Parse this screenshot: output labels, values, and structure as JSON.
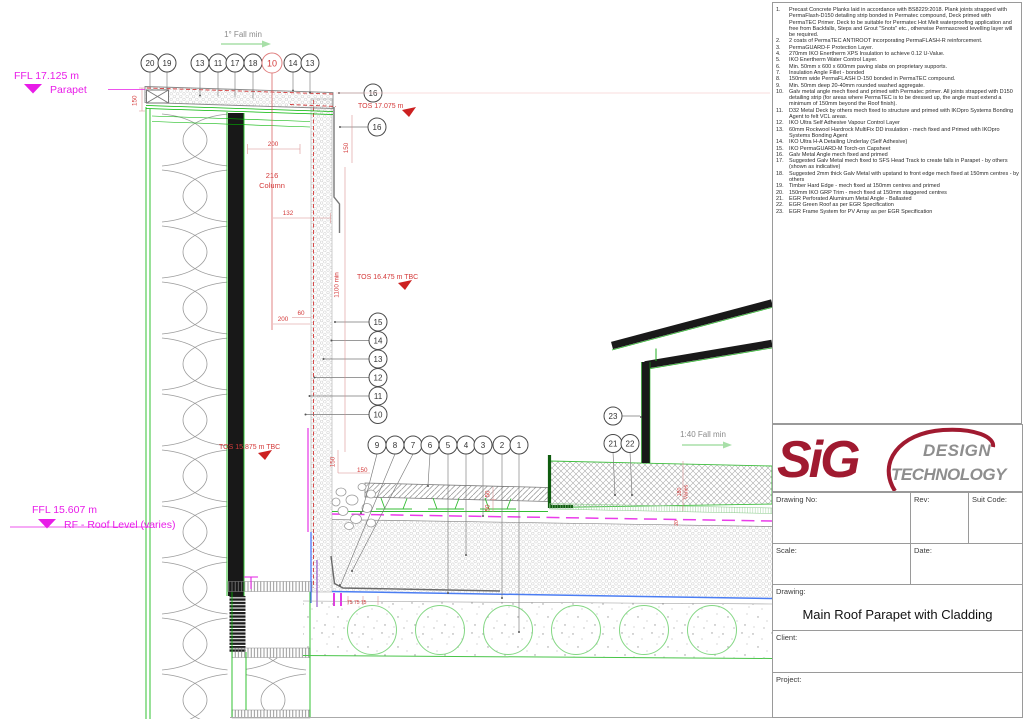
{
  "notes": {
    "items": [
      {
        "n": "1.",
        "t": "Precast Concrete Planks laid in accordance with BS8229:2018.  Plank joints strapped with PermaFlash-D150 detailing strip bonded in Permatec compound, Deck primed with PermaTEC Primer.  Deck to be suitable for Permatec Hot Melt waterproofing application and free from Backfalls, Steps and Grout \"Snots\" etc., otherwise Permascreed levelling layer will be required."
      },
      {
        "n": "2.",
        "t": "2 coats of PermaTEC ANTIROOT incorporating PermaFLASH-R reinforcement."
      },
      {
        "n": "3.",
        "t": "PermaGUARD-F Protection Layer."
      },
      {
        "n": "4.",
        "t": "270mm IKO Enertherm XPS Insulation to achieve 0.12 U-Value."
      },
      {
        "n": "5.",
        "t": "IKO Enertherm Water Control Layer."
      },
      {
        "n": "6.",
        "t": "Min. 50mm x 600 x 600mm paving slabs on proprietary supports."
      },
      {
        "n": "7.",
        "t": "Insulation Angle Fillet - bonded"
      },
      {
        "n": "8.",
        "t": "150mm wide PermaFLASH D-150 bonded in PermaTEC compound."
      },
      {
        "n": "9.",
        "t": "Min. 50mm deep 20-40mm rounded washed aggregate."
      },
      {
        "n": "10.",
        "t": "Galv metal angle mech fixed and primed with Permatec primer. All joints strapped with D150 detailing strip (for areas where PermaTEC is to be dressed up, the angle must extend a minimum of 150mm beyond the Roof finish)."
      },
      {
        "n": "11.",
        "t": "D32 Metal Deck by others mech fixed to structure and primed with IKOpro Systems Bonding Agent to felt VCL areas."
      },
      {
        "n": "12.",
        "t": "IKO Ultra Self Adhesive Vapour Control Layer"
      },
      {
        "n": "13.",
        "t": "60mm Rockwool Hardrock MultiFix DD insulation - mech fixed and Primed with IKOpro Systems Bonding Agent"
      },
      {
        "n": "14.",
        "t": "IKO Ultra H-A Detailing Underlay (Self Adhesive)"
      },
      {
        "n": "15.",
        "t": "IKO PermaGUARD-M Torch-on Capsheet"
      },
      {
        "n": "16.",
        "t": "Galv Metal Angle mech fixed and primed"
      },
      {
        "n": "17.",
        "t": "Suggested Galv Metal mech fixed to SFS Head Track to create falls in Parapet - by others (shown as indicative)"
      },
      {
        "n": "18.",
        "t": "Suggested 2mm thick Galv Metal with upstand to front edge mech fixed at 150mm centres - by others"
      },
      {
        "n": "19.",
        "t": "Timber Hard Edge - mech fixed at 150mm centres and primed"
      },
      {
        "n": "20.",
        "t": "150mm IKO GRP Trim - mech fixed at 150mm staggered centres"
      },
      {
        "n": "21.",
        "t": "EGR Perforated Aluminum Metal Angle - Ballasted"
      },
      {
        "n": "22.",
        "t": "EGR Green Roof as per EGR Specification"
      },
      {
        "n": "23.",
        "t": "EGR Frame System for PV Array as per EGR Specification"
      }
    ]
  },
  "drawing": {
    "falls": {
      "top": "1° Fall min",
      "roof": "1:40 Fall min"
    },
    "levels": {
      "ffl_parapet": "FFL 17.125 m",
      "parapet": "Parapet",
      "ffl_roof": "FFL 15.607 m",
      "roof": "RF - Roof Level (varies)",
      "tos_top": "TOS 17.075 m",
      "tos_mid": "TOS 16.475 m TBC",
      "tos_low": "TOS 15.875 m TBC"
    },
    "dims": {
      "d150_left": "150",
      "d200": "200",
      "col_216": "216",
      "col_word": "Column",
      "d132": "132",
      "d1100": "1100 min",
      "d150_mid": "150",
      "d60": "60",
      "d200b": "200",
      "d150_v": "150",
      "d150_h": "150",
      "d50a": "50",
      "d50b": "50",
      "d75": "75   75   75",
      "d180a": "180",
      "d180b": "Varies",
      "d20": "20"
    },
    "callouts_top": [
      "20",
      "19",
      "13",
      "11",
      "17",
      "18",
      "10",
      "14",
      "13"
    ],
    "callout_16a": "16",
    "callout_16b": "16",
    "callouts_stack": [
      "15",
      "14",
      "13",
      "12",
      "11",
      "10"
    ],
    "callouts_row": [
      "9",
      "8",
      "7",
      "6",
      "5",
      "4",
      "3",
      "2",
      "1"
    ],
    "callout_23": "23",
    "callout_21": "21",
    "callout_22": "22",
    "colors": {
      "dim_red": "#d43a3a",
      "level_magenta": "#e81ce8",
      "line_green": "#00b400",
      "brand_red": "#a01a30"
    }
  },
  "titleblock": {
    "logo_sig": "SiG",
    "logo_line1": "DESIGN",
    "logo_line2": "TECHNOLOGY",
    "drawing_no_label": "Drawing No:",
    "rev_label": "Rev:",
    "suit_code_label": "Suit Code:",
    "scale_label": "Scale:",
    "date_label": "Date:",
    "drawing_label": "Drawing:",
    "drawing_title": "Main Roof  Parapet with Cladding",
    "client_label": "Client:",
    "project_label": "Project:"
  }
}
